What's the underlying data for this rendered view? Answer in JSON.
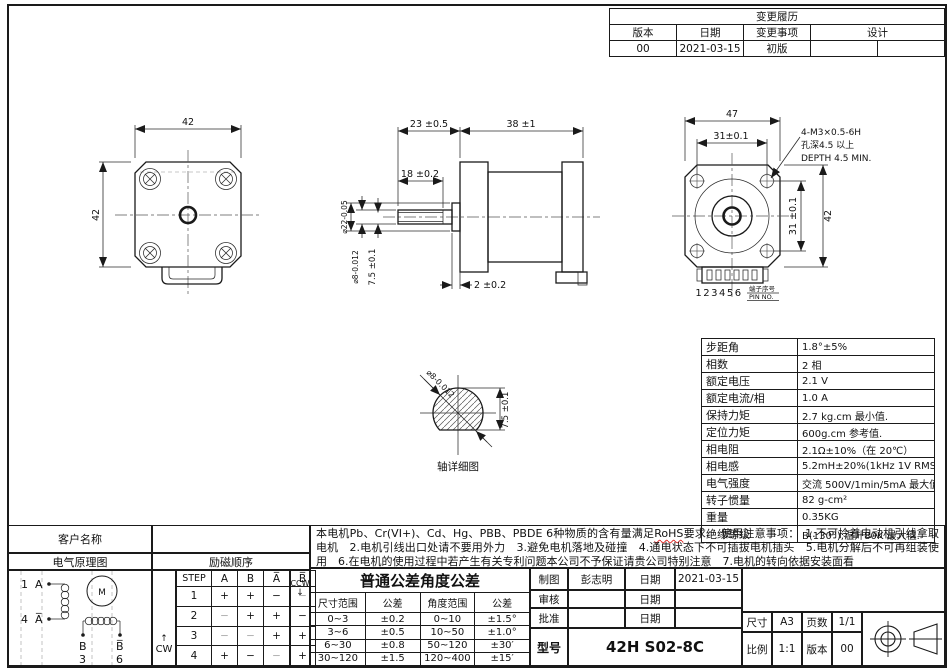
{
  "colors": {
    "line": "#1a1a1a",
    "rohs_underline": "#e0312f",
    "light_cell": "#a8a8a8"
  },
  "change_history": {
    "title": "变更履历",
    "col_version": "版本",
    "col_date": "日期",
    "col_item": "变更事项",
    "col_designer": "设计",
    "row": {
      "version": "00",
      "date": "2021-03-15",
      "item": "初版"
    }
  },
  "views": {
    "front": {
      "dim_width": "42",
      "dim_height": "42"
    },
    "side": {
      "dim_shaft_len": "23 ±0.5",
      "dim_body_len": "38 ±1",
      "dim_flat_len": "18 ±0.2",
      "dim_boss": "2 ±0.2",
      "dim_boss_dia": "⌀22-0.05",
      "dim_shaft_dia": "⌀8-0.012",
      "dim_flat_depth": "7.5 ±0.1"
    },
    "rear": {
      "dim_width": "47",
      "dim_hole_span_h": "31±0.1",
      "dim_hole_span_v": "31 ±0.1",
      "dim_height": "42",
      "callout_1": "4-M3×0.5-6H",
      "callout_2": "孔深4.5 以上",
      "callout_3": "DEPTH 4.5 MIN.",
      "pin_numbers": "123456",
      "pin_label_cn": "端子序号",
      "pin_label_en": "PIN NO."
    },
    "shaft_detail": {
      "dim_dia": "⌀8-0.012",
      "dim_flat": "7.5 ±0.1",
      "caption": "轴详细图"
    }
  },
  "specs": {
    "rows": [
      {
        "label": "步距角",
        "value": "1.8°±5%"
      },
      {
        "label": "相数",
        "value": "2 相"
      },
      {
        "label": "额定电压",
        "value": "2.1 V"
      },
      {
        "label": "额定电流/相",
        "value": "1.0 A"
      },
      {
        "label": "保持力矩",
        "value": "2.7 kg.cm 最小值."
      },
      {
        "label": "定位力矩",
        "value": "600g.cm 参考值."
      },
      {
        "label": "相电阻",
        "value": "2.1Ω±10%（在 20℃）"
      },
      {
        "label": "相电感",
        "value": "5.2mH±20%(1kHz 1V RMS)"
      },
      {
        "label": "电气强度",
        "value": "交流 500V/1min/5mA 最大值."
      },
      {
        "label": "转子惯量",
        "value": "82 g-cm²"
      },
      {
        "label": "重量",
        "value": "0.35KG"
      },
      {
        "label": "绝缘等级",
        "value": "B(130°);温升80K 最大值."
      }
    ]
  },
  "notes": {
    "part1": "本电机Pb、Cr(VI+)、Cd、Hg、PBB、PBDE 6种物质的含有量满足",
    "rohs": "RoHS",
    "part2": "要求.　使用注意事项：　1.不可拎着电动机引线拿取电机　2.电机引线出口处请不要用外力　3.避免电机落地及碰撞　4.通电状态下不可插拔电机插头　5.电机分解后不可再组装使用　6.在电机的使用过程中若产生有关专利问题本公司不予保证请贵公司特别注意　7.电机的转向依据安装面看"
  },
  "customer": {
    "label": "客户名称"
  },
  "schematic": {
    "title": "电气原理图",
    "t1": "1",
    "tA": "A",
    "t4": "4",
    "tAbar": "A̅",
    "tB": "B",
    "t3": "3",
    "tBbar": "B̅",
    "t6": "6",
    "motor": "M"
  },
  "sequence": {
    "title": "励磁顺序",
    "cw": "CW",
    "ccw": "CCW",
    "headers": [
      "STEP",
      "A",
      "B",
      "A̅",
      "B̅"
    ],
    "rows": [
      [
        "1",
        "+",
        "+",
        "−",
        "−"
      ],
      [
        "2",
        "−",
        "+",
        "+",
        "−"
      ],
      [
        "3",
        "−",
        "−",
        "+",
        "+"
      ],
      [
        "4",
        "+",
        "−",
        "−",
        "+"
      ]
    ]
  },
  "tolerance": {
    "title": "普通公差角度公差",
    "h_dim_range": "尺寸范围",
    "h_tol": "公差",
    "h_angle_range": "角度范围",
    "h_tol2": "公差",
    "rows": [
      [
        "0~3",
        "±0.2",
        "0~10",
        "±1.5°"
      ],
      [
        "3~6",
        "±0.5",
        "10~50",
        "±1.0°"
      ],
      [
        "6~30",
        "±0.8",
        "50~120",
        "±30′"
      ],
      [
        "30~120",
        "±1.5",
        "120~400",
        "±15′"
      ]
    ]
  },
  "titleblock": {
    "draw_label": "制图",
    "draw_name": "彭志明",
    "date_label_1": "日期",
    "draw_date": "2021-03-15",
    "check_label": "审核",
    "date_label_2": "日期",
    "approve_label": "批准",
    "date_label_3": "日期",
    "model_label": "型号",
    "model": "42H S02-8C",
    "size_label": "尺寸",
    "size": "A3",
    "pages_label": "页数",
    "pages": "1/1",
    "scale_label": "比例",
    "scale": "1:1",
    "version_label": "版本",
    "version": "00"
  }
}
